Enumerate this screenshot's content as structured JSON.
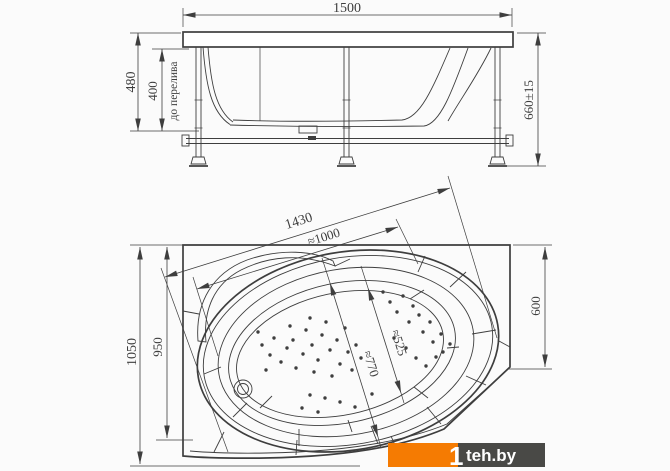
{
  "colors": {
    "line": "#3e3e3e",
    "background": "#fbfbfb",
    "logo_orange": "#f57b02",
    "logo_gray": "#494946",
    "logo_text": "#ffffff"
  },
  "side_view": {
    "dim_width": "1500",
    "dim_height": "480",
    "dim_height_overflow": "400",
    "overflow_note": "до перелива",
    "dim_total_height": "660±15"
  },
  "plan_view": {
    "dim_diagonal_length": "1430",
    "dim_inner_length": "≈1000",
    "dim_depth": "1050",
    "dim_inner_depth": "950",
    "dim_right_width": "600",
    "dim_basin_width": "≈525",
    "dim_basin_length": "≈770"
  },
  "watermark": {
    "mark": "1",
    "site": "teh.by"
  }
}
